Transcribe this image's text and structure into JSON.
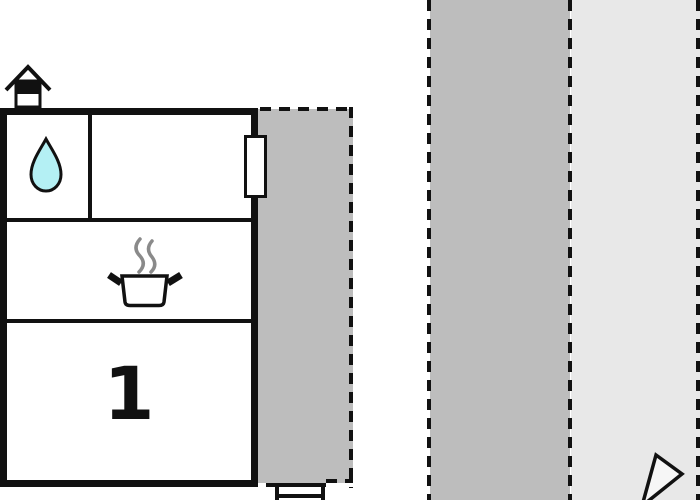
{
  "plan": {
    "type": "floor-plan",
    "rooms": {
      "room1_label": "1",
      "bathroom_icon": "water-drop-icon",
      "kitchen_icon": "cooking-pot-icon"
    },
    "icons": [
      {
        "name": "house-entrance-icon",
        "meaning": "entrance / house symbol"
      },
      {
        "name": "water-drop-icon",
        "meaning": "bathroom / water"
      },
      {
        "name": "cooking-pot-icon",
        "meaning": "kitchen / stove"
      },
      {
        "name": "compass-arrow-icon",
        "meaning": "orientation arrow tip"
      }
    ],
    "areas": [
      {
        "name": "terrace-area",
        "border": "dashed"
      },
      {
        "name": "garden-path-strip",
        "border": "dashed"
      },
      {
        "name": "lawn-strip",
        "border": "dashed"
      }
    ]
  },
  "colors": {
    "wall": "#111111",
    "terrace": "#bdbdbd",
    "path": "#bdbdbd",
    "lawn": "#e8e8e8",
    "drop": "#b4f0f4",
    "steam": "#8a8a8a",
    "paper": "#ffffff"
  }
}
